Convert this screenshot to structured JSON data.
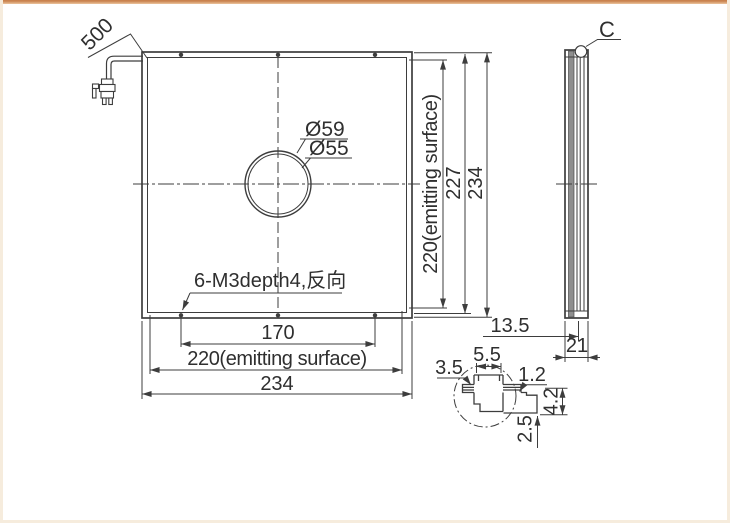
{
  "front_view": {
    "cable_length": "500",
    "hole_diameter_outer": "Ø59",
    "hole_diameter_inner": "Ø55",
    "thread_note": "6-M3depth4,反向",
    "dim_holes_width": "170",
    "dim_emitting_width": "220(emitting surface)",
    "dim_outer_width": "234",
    "dim_emitting_height": "220(emitting surface)",
    "dim_inner_height": "227",
    "dim_outer_height": "234"
  },
  "side_view": {
    "section_label": "C",
    "dim_front_depth": "13.5",
    "dim_total_depth": "21"
  },
  "detail_view": {
    "dim_groove_offset": "3.5",
    "dim_slot_width": "5.5",
    "dim_step": "1.2",
    "dim_flange_height": "4.2",
    "dim_lip": "2.5"
  },
  "colors": {
    "line": "#3d3d3d",
    "accent_bar_dark": "#c9824e",
    "accent_bar_light": "#ecc49d",
    "background": "#ffffff"
  }
}
